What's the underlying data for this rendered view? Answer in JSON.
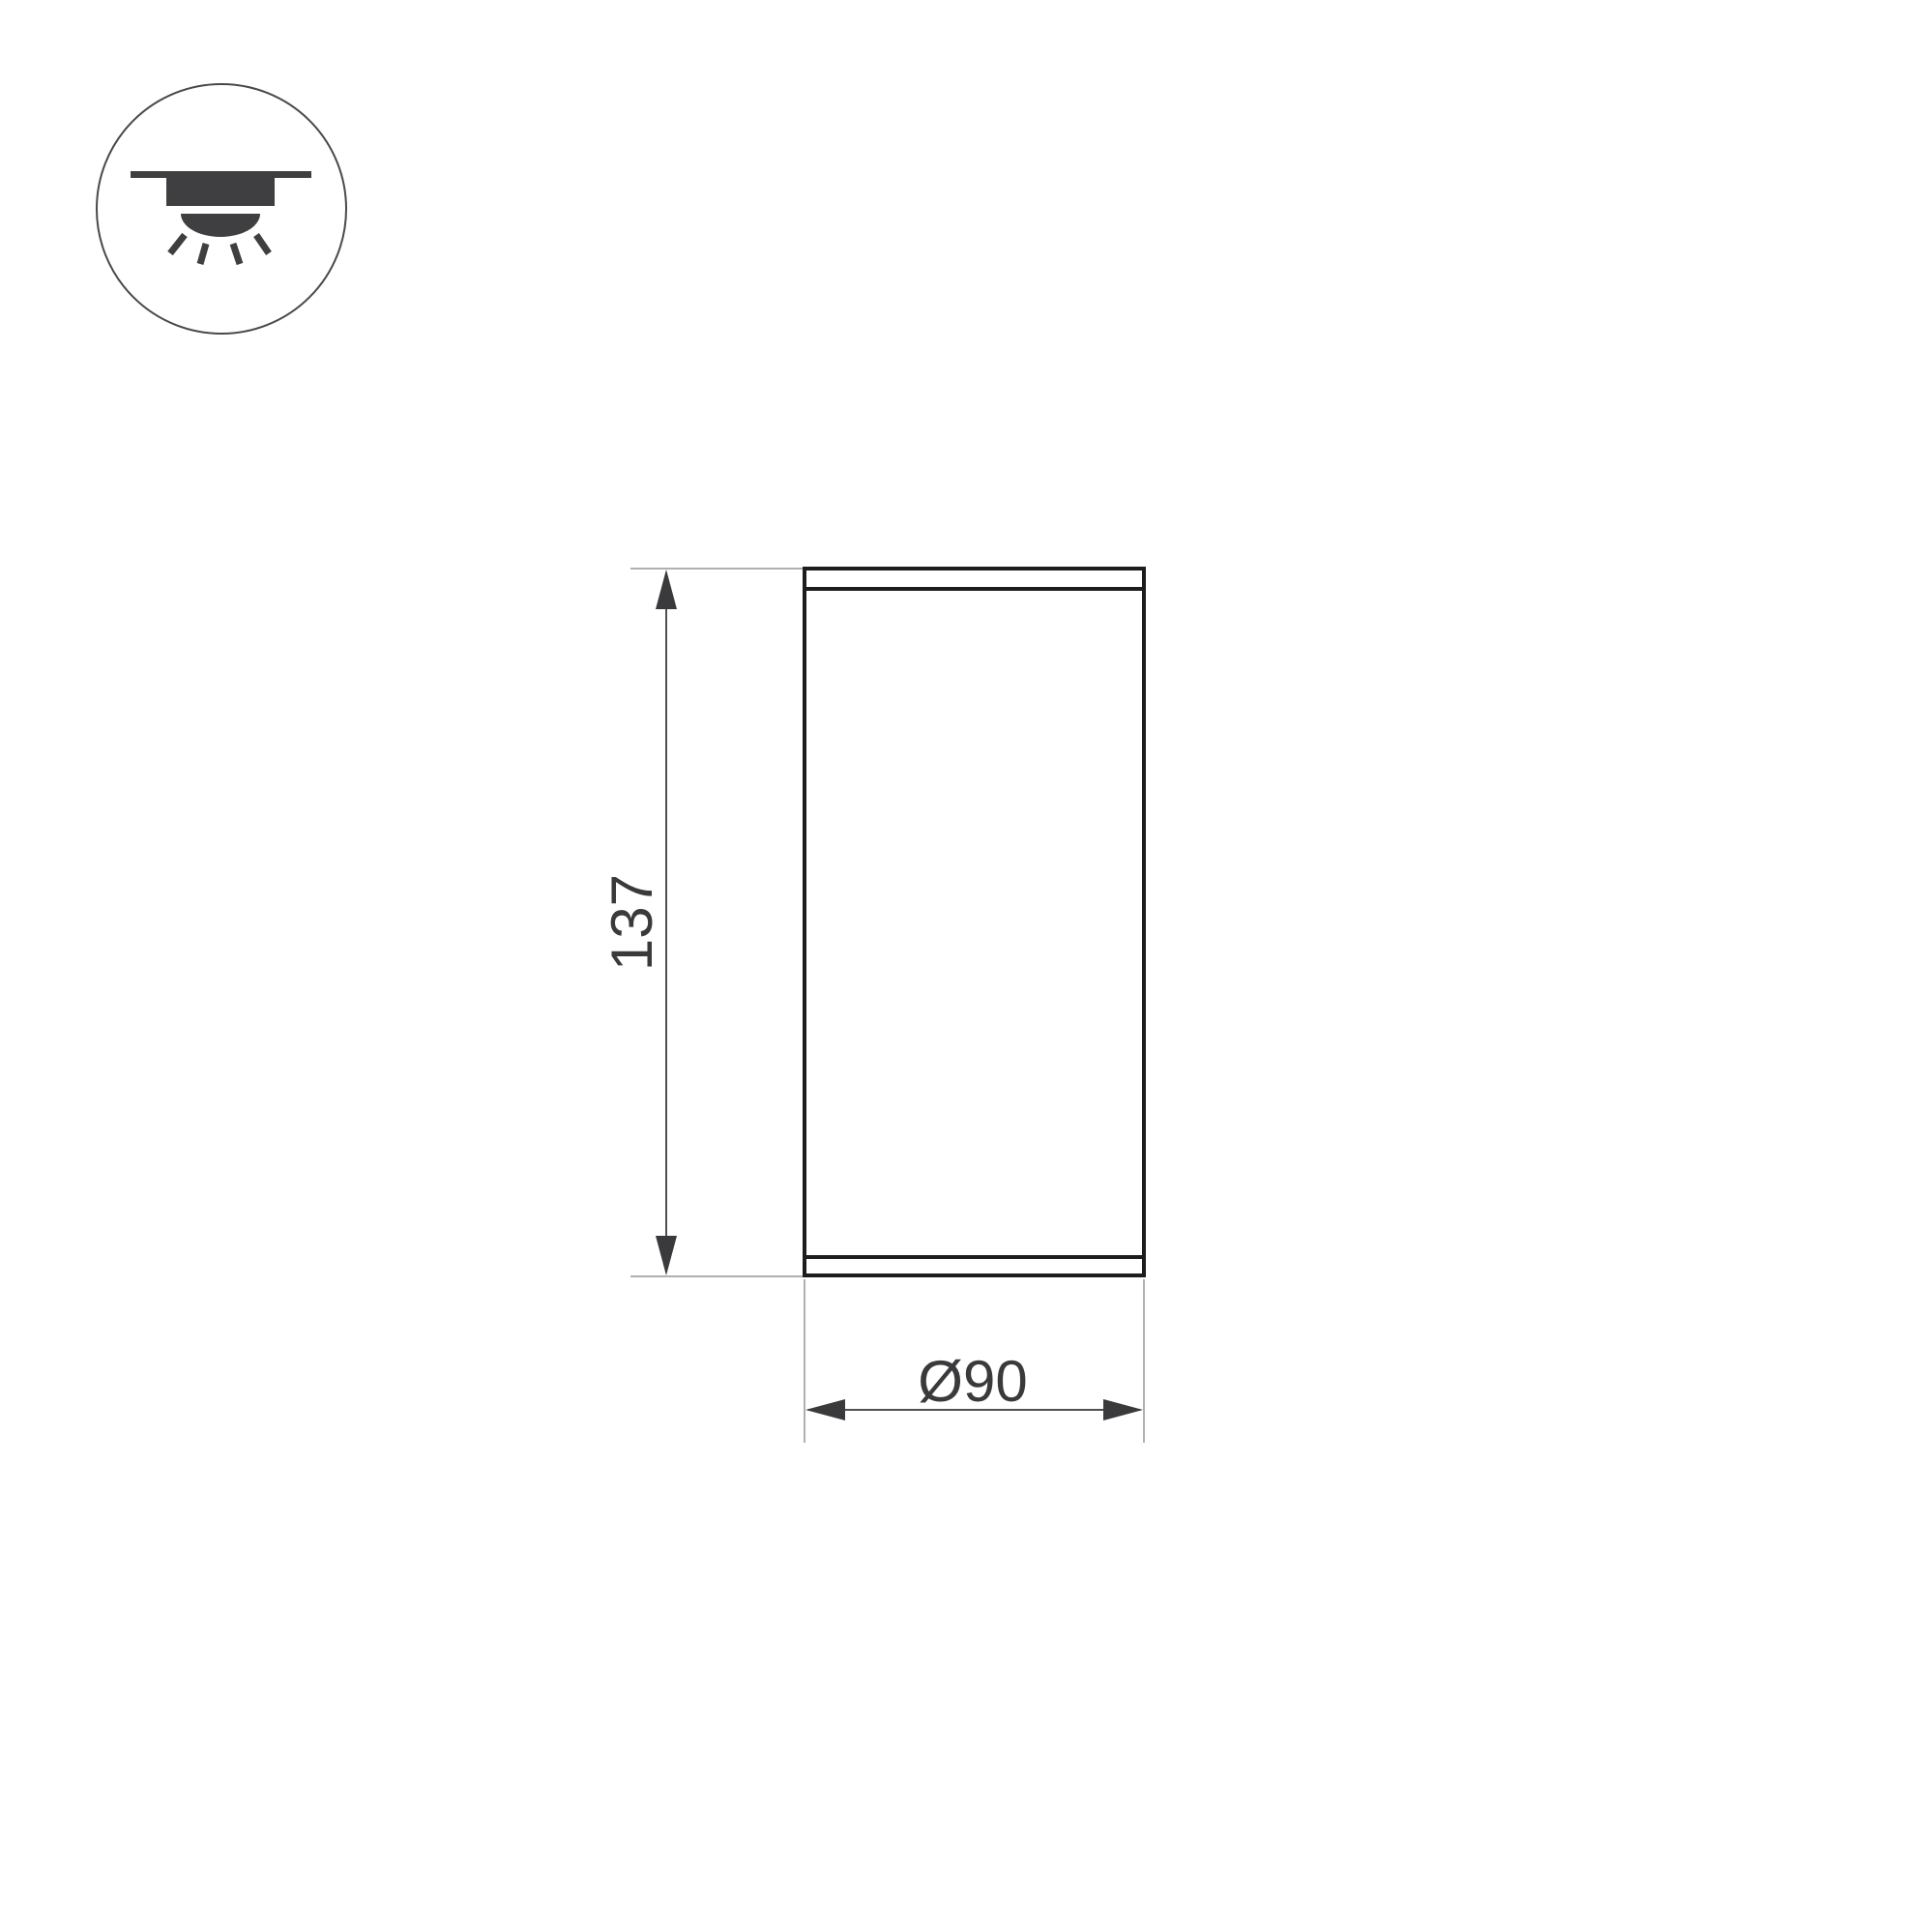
{
  "colors": {
    "background": "#ffffff",
    "outline": "#1d1d1f",
    "dim-line": "#4f4f51",
    "ext-line": "#b0b0b2",
    "accent-text": "#3a3a3c",
    "icon": "#3f3f41",
    "icon-circle": "#49494b"
  },
  "icon": {
    "type": "surface-mounted-downlight-pictogram"
  },
  "drawing": {
    "height_label": "137",
    "diameter_label": "Ø90"
  }
}
